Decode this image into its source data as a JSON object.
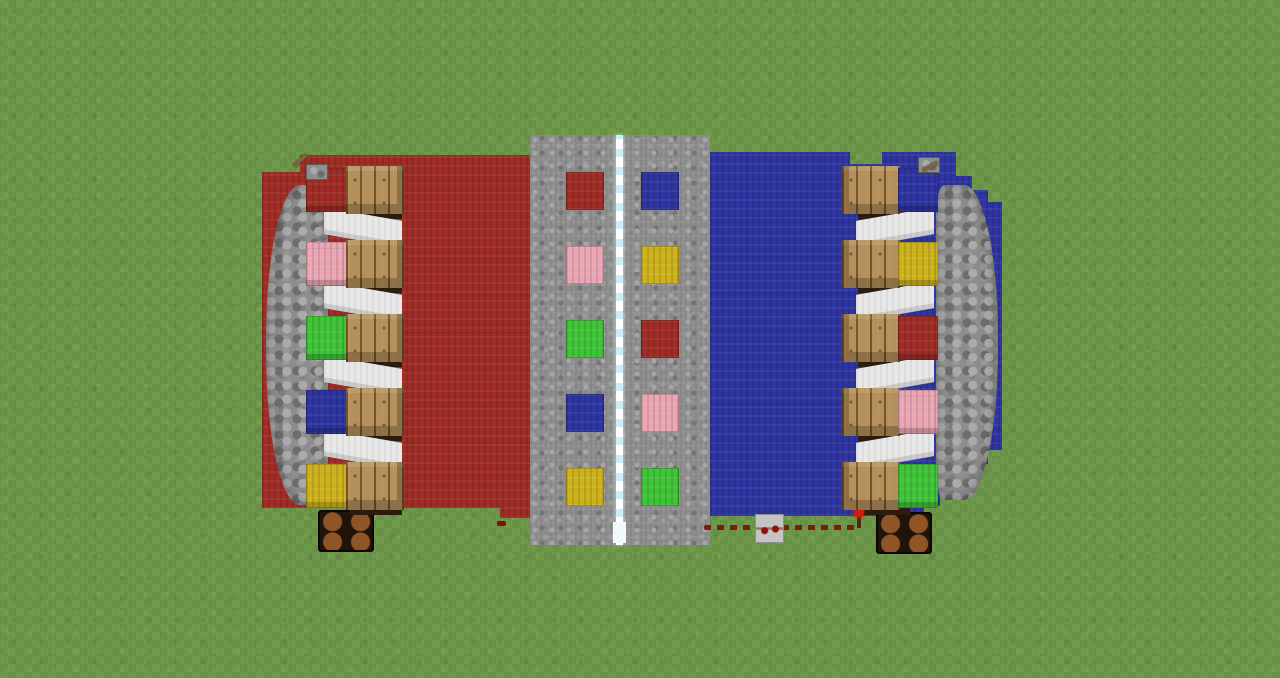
{
  "scene": {
    "game": "Minecraft",
    "view": "top-down overhead of a symmetric two-team redstone color-sequence arena"
  },
  "palette": {
    "grass": "#6f9a4b",
    "gravel": "#8e8e8e",
    "divider": "#cdedf4",
    "cobble": "#8d8d8d",
    "plank": "#b5905a",
    "whiteWool": "#e8e8e8",
    "redWool": "#a02c26",
    "blueWool": "#2e34a0",
    "pinkWool": "#eba6b4",
    "greenWool": "#3fc437",
    "yellowWool": "#cdb11c",
    "lampFrame": "#20130a",
    "lampGlow": "#8f5527",
    "redstone": "#7d120a"
  },
  "center_board": {
    "left_column_sequence": [
      "red",
      "pink",
      "green",
      "blue",
      "yellow"
    ],
    "right_column_sequence": [
      "blue",
      "yellow",
      "red",
      "pink",
      "green"
    ],
    "divider_block": "white ice/glass line"
  },
  "left_station": {
    "field_color": "red",
    "button_sequence": [
      "red",
      "pink",
      "green",
      "blue",
      "yellow"
    ],
    "wall": "cobblestone arc",
    "lever": "lever on red wool",
    "lamp": "redstone lamp (unlit)"
  },
  "right_station": {
    "field_color": "blue",
    "button_sequence": [
      "blue",
      "yellow",
      "red",
      "pink",
      "green"
    ],
    "wall": "cobblestone arc",
    "lever": "lever on blue wool",
    "lamp": "redstone lamp (unlit)"
  },
  "redstone_circuit": {
    "components": [
      "redstone dust trail",
      "redstone repeater",
      "redstone torch",
      "dust speck near red field"
    ]
  }
}
